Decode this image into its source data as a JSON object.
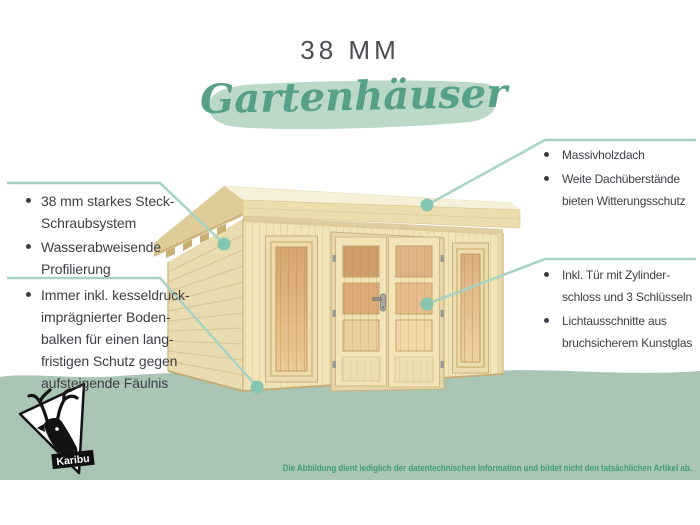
{
  "title": "38 MM",
  "subtitle": "Gartenhäuser",
  "callouts": {
    "left1": {
      "items": [
        "38 mm starkes Steck-\nSchraubsystem",
        "Wasserabweisende\nProfilierung"
      ]
    },
    "left2": {
      "items": [
        "Immer inkl. kesseldruck-\nimprägnierter Boden-\nbalken für einen lang-\nfristigen Schutz gegen\naufsteigende Fäulnis"
      ]
    },
    "right1": {
      "items": [
        "Massivholzdach",
        "Weite Dachüberstände\nbieten Witterungsschutz"
      ]
    },
    "right2": {
      "items": [
        "Inkl. Tür mit Zylinder-\nschloss und 3 Schlüsseln",
        "Lichtausschnitte aus\nbruchsicherem Kunstglas"
      ]
    }
  },
  "footer": {
    "disclaimer": "Die Abbildung dient lediglich der datentechnischen Information und bildet nicht den tatsächlichen Artikel ab."
  },
  "logo": {
    "brand": "Karibu",
    "icon": "deer-head-icon"
  },
  "colors": {
    "accent_green": "#55a086",
    "band_green": "#aac5b4",
    "brush_green": "#bcd8c7",
    "callout_line": "#a8d3c3",
    "callout_dot": "#85c6b2",
    "text_dark": "#3e3e46",
    "title_gray": "#4b4b53",
    "disclaimer_green": "#3f9f72"
  }
}
